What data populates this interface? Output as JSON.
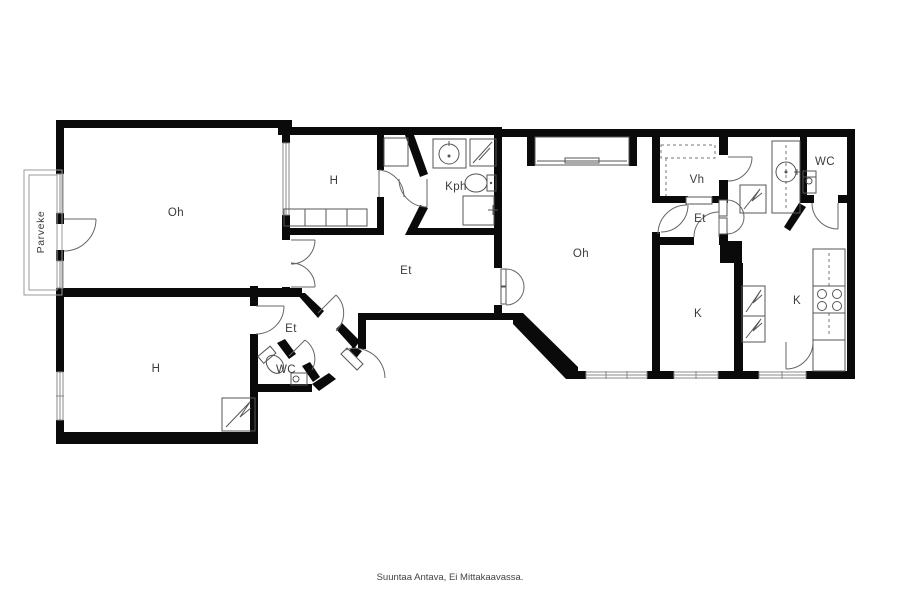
{
  "rooms": [
    {
      "id": "oh-left",
      "label": "Oh"
    },
    {
      "id": "h-top",
      "label": "H"
    },
    {
      "id": "kph",
      "label": "Kph"
    },
    {
      "id": "et-main",
      "label": "Et"
    },
    {
      "id": "oh-right",
      "label": "Oh"
    },
    {
      "id": "vh",
      "label": "Vh"
    },
    {
      "id": "et-right",
      "label": "Et"
    },
    {
      "id": "k-left",
      "label": "K"
    },
    {
      "id": "k-right",
      "label": "K"
    },
    {
      "id": "wc-right",
      "label": "WC"
    },
    {
      "id": "h-bottom",
      "label": "H"
    },
    {
      "id": "et-small",
      "label": "Et"
    },
    {
      "id": "wc-small",
      "label": "WC"
    },
    {
      "id": "parveke",
      "label": "Parveke"
    }
  ],
  "footer": {
    "note": "Suuntaa Antava, Ei Mittakaavassa."
  },
  "colors": {
    "wall": "#0a0a0a",
    "fixture_line": "#555555",
    "label": "#3c3c3c",
    "background": "#ffffff"
  }
}
